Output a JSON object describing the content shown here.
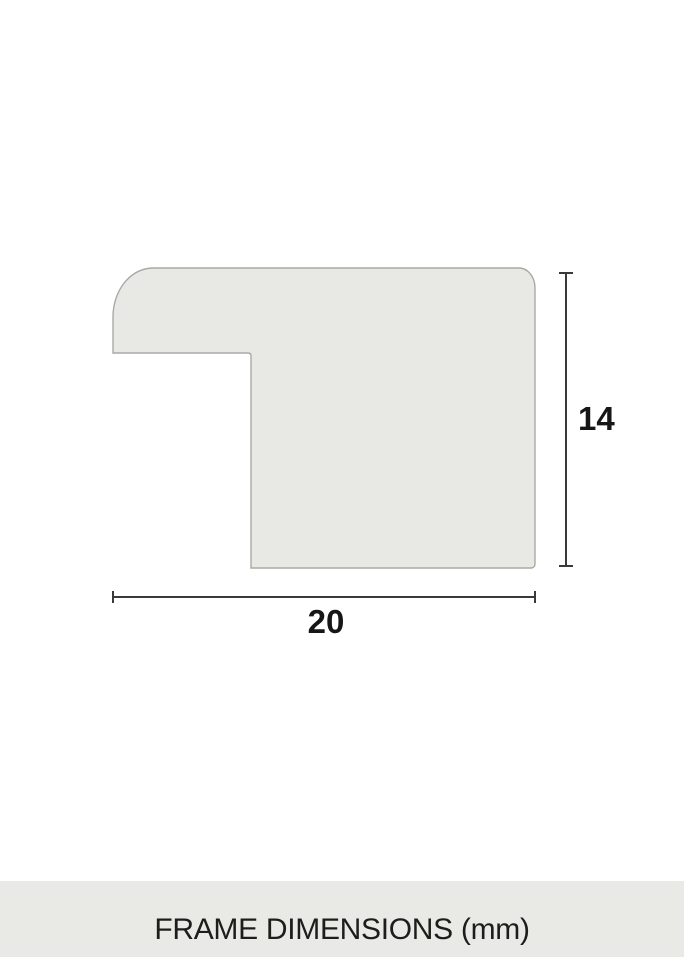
{
  "diagram": {
    "type": "frame-profile-cross-section",
    "height_label": "14",
    "width_label": "20"
  },
  "caption": {
    "title": "FRAME DIMENSIONS (mm)"
  },
  "colors": {
    "page_bg": "#ffffff",
    "shape_fill": "#e8e9e4",
    "shape_stroke": "#a9aaa6",
    "dimension_line": "#3a3a3a",
    "dimension_text": "#161616",
    "caption_bg": "#e9e9e5",
    "caption_text": "#1d1d1b"
  }
}
